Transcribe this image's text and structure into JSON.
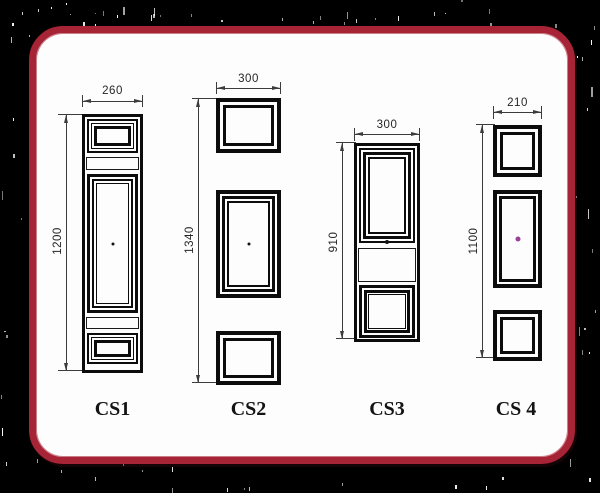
{
  "designs": [
    {
      "id": "cs1",
      "label": "CS1",
      "width_dim": "260",
      "height_dim": "1200"
    },
    {
      "id": "cs2",
      "label": "CS2",
      "width_dim": "300",
      "height_dim": "1340"
    },
    {
      "id": "cs3",
      "label": "CS3",
      "width_dim": "300",
      "height_dim": "910"
    },
    {
      "id": "cs4",
      "label": "CS 4",
      "width_dim": "210",
      "height_dim": "1100"
    }
  ],
  "colors": {
    "background": "#000000",
    "card_background": "#fdfdfd",
    "card_border": "#a62435",
    "drawing_line": "#0c0c0c",
    "dimension_line": "#3c3c3c",
    "cs4_center_dot": "#9c3f97"
  }
}
